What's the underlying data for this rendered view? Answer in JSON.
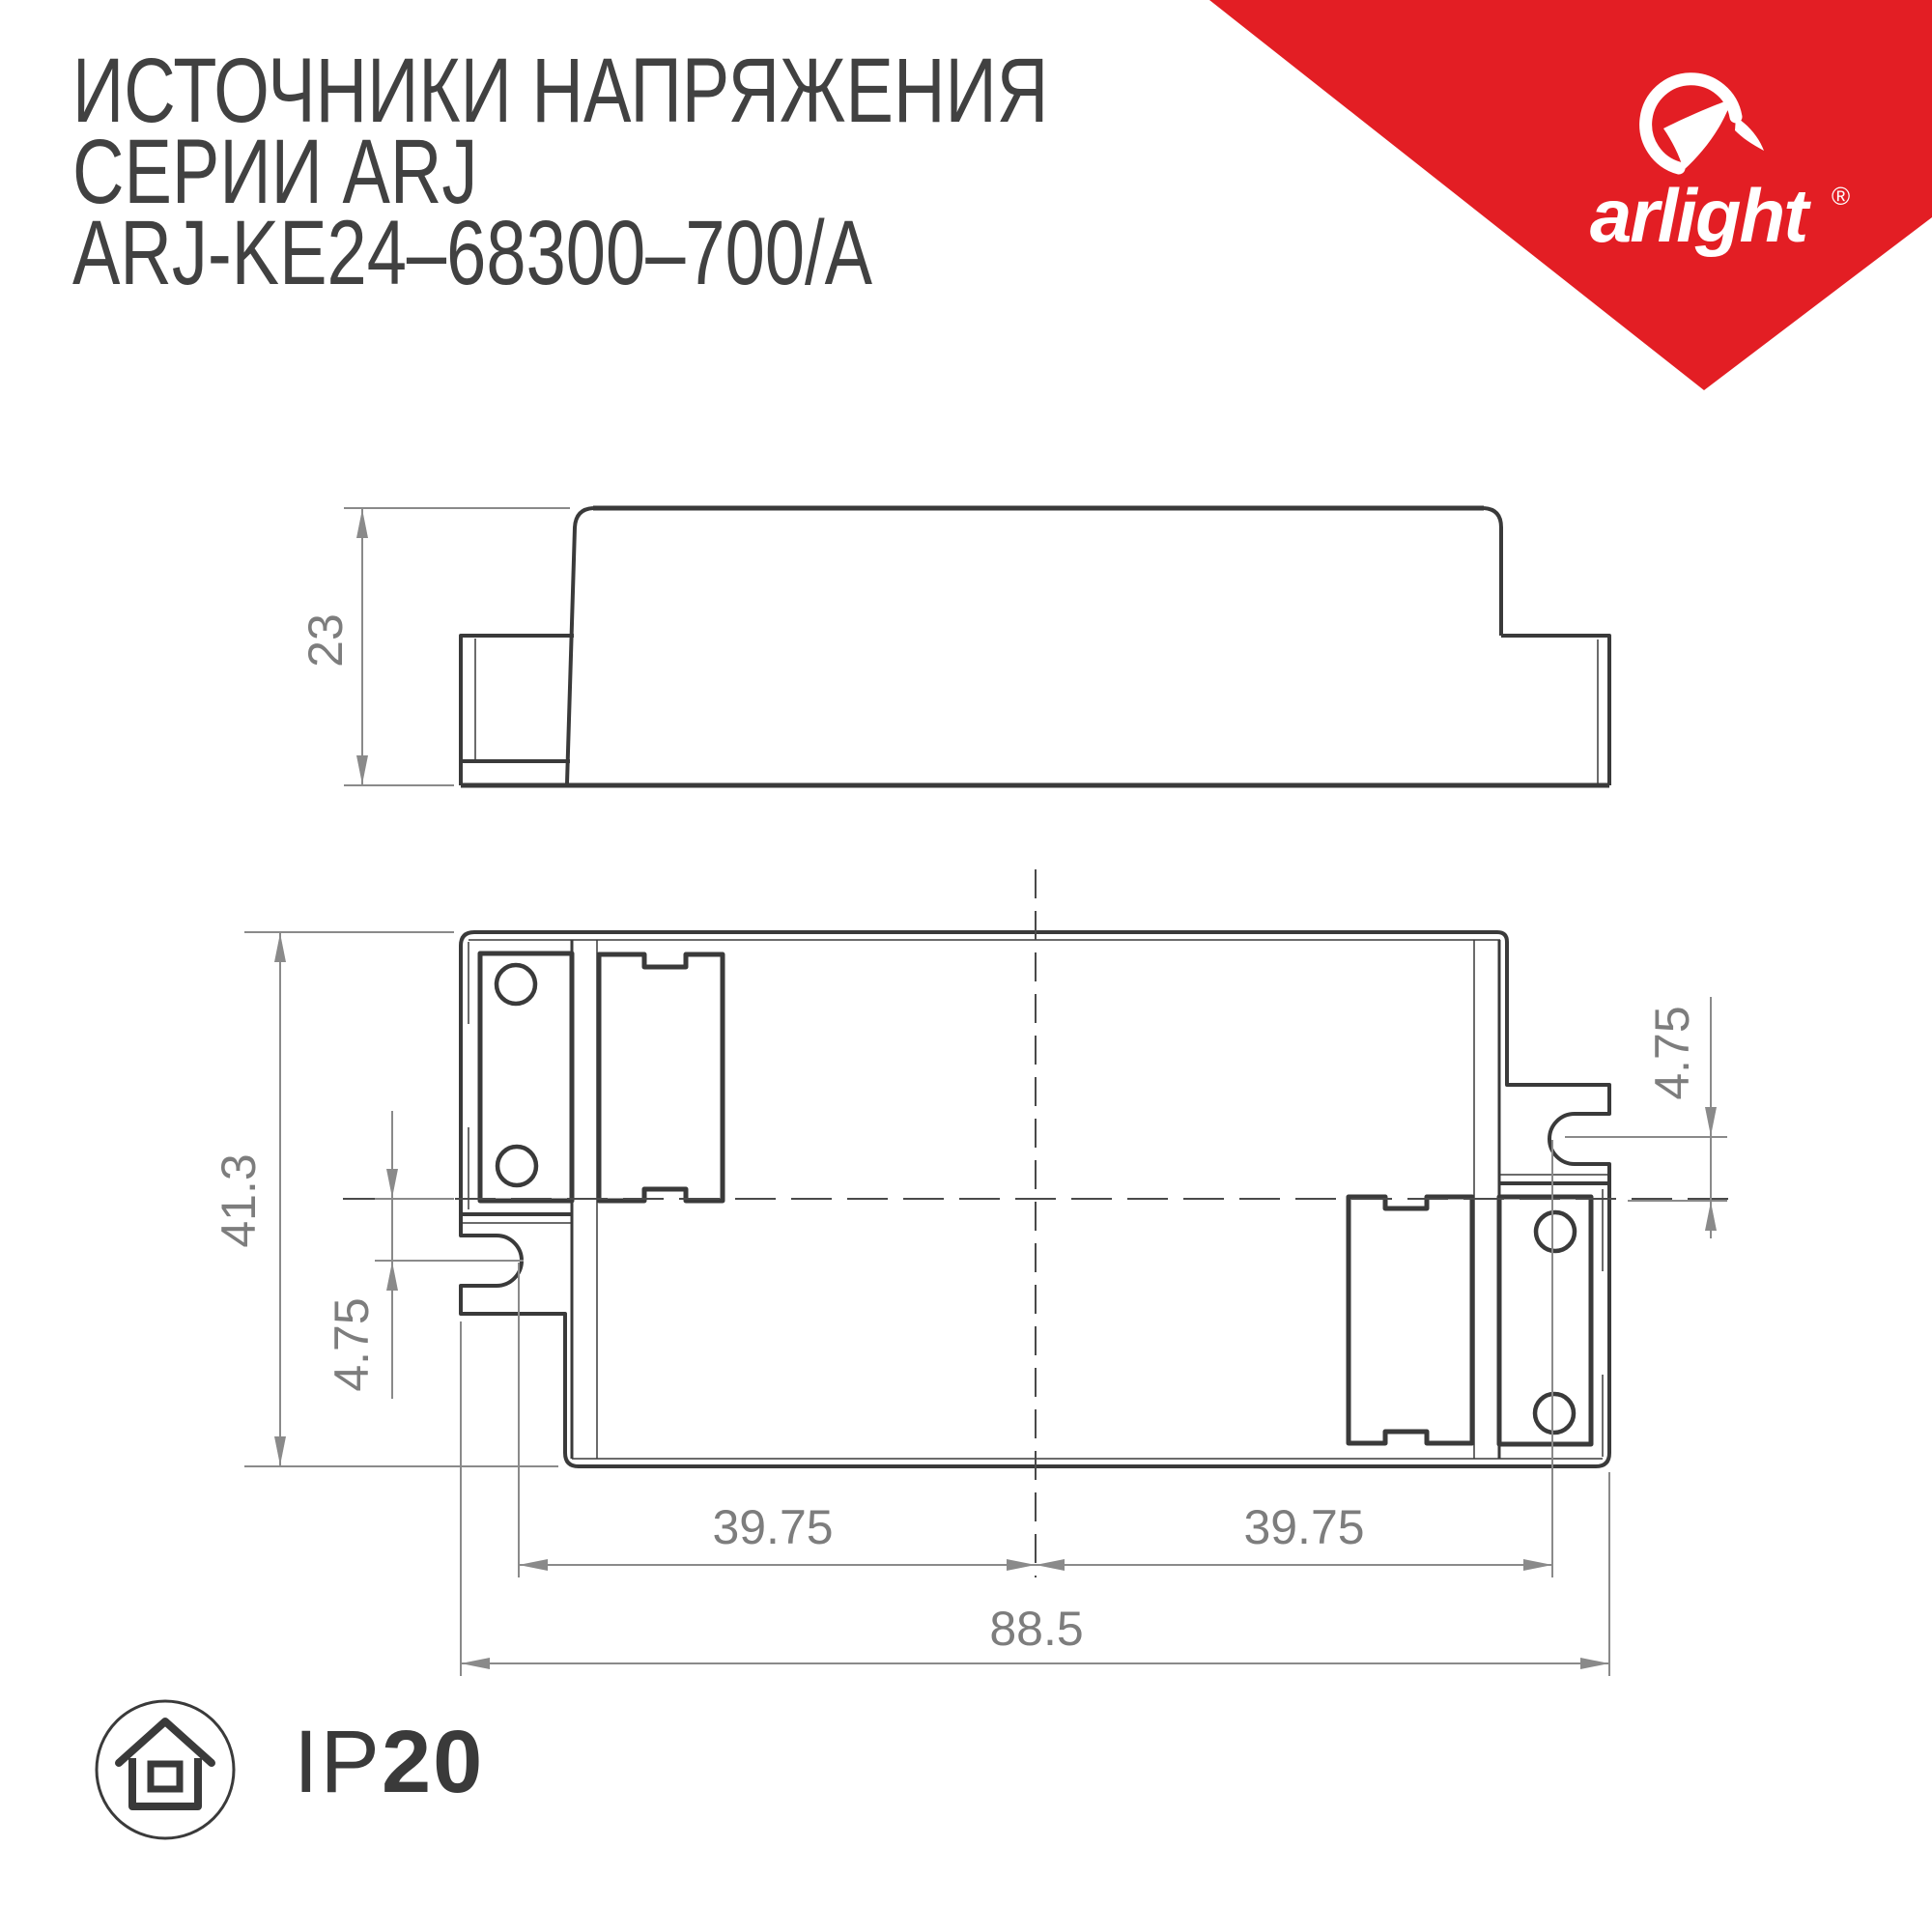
{
  "header": {
    "title_line1": "ИСТОЧНИКИ НАПРЯЖЕНИЯ",
    "title_line2": "СЕРИИ ARJ",
    "title_line3": "ARJ-KE24–68300–700/А"
  },
  "brand": {
    "logo_text": "arlight",
    "registered_mark": "®",
    "banner_color": "#e31e24"
  },
  "drawing": {
    "dimensions": {
      "height_side": "23",
      "depth": "41.3",
      "slot_offset_left": "4.75",
      "slot_offset_right": "4.75",
      "mount_left": "39.75",
      "mount_right": "39.75",
      "length_total": "88.5"
    },
    "colors": {
      "line_dark": "#3a3a3a",
      "line_dim": "#8a8a8a",
      "text_dim": "#7d7d7d"
    }
  },
  "footer": {
    "ip_prefix": "IP",
    "ip_value": "20"
  }
}
